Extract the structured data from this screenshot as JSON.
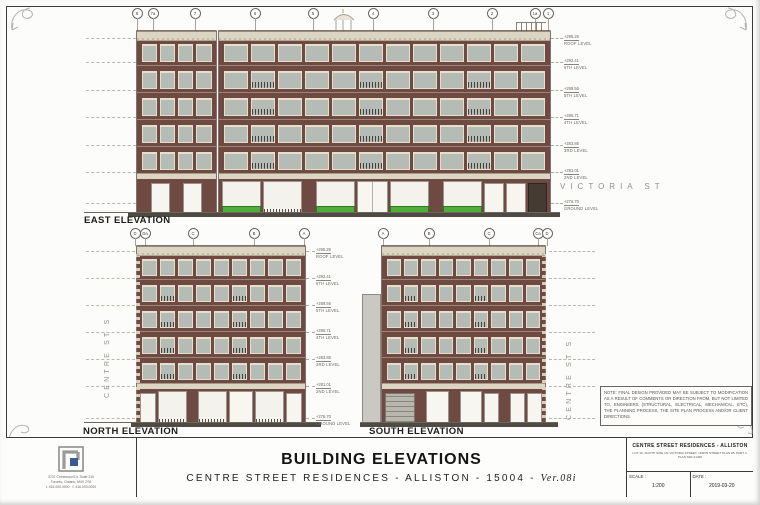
{
  "drawing": {
    "east": {
      "label": "EAST ELEVATION",
      "street": "VICTORIA ST",
      "bubbles": [
        {
          "x": 136,
          "label": "8"
        },
        {
          "x": 152,
          "label": "7a"
        },
        {
          "x": 194,
          "label": "7"
        },
        {
          "x": 254,
          "label": "6"
        },
        {
          "x": 312,
          "label": "5"
        },
        {
          "x": 372,
          "label": "4"
        },
        {
          "x": 432,
          "label": "3"
        },
        {
          "x": 491,
          "label": "2"
        },
        {
          "x": 534,
          "label": "1a"
        },
        {
          "x": 547,
          "label": "1"
        }
      ]
    },
    "north": {
      "label": "NORTH ELEVATION",
      "street": "CENTRE ST S",
      "bubbles": [
        {
          "x": 134,
          "label": "D"
        },
        {
          "x": 144,
          "label": "Da"
        },
        {
          "x": 192,
          "label": "C"
        },
        {
          "x": 253,
          "label": "B"
        },
        {
          "x": 303,
          "label": "A"
        }
      ]
    },
    "south": {
      "label": "SOUTH ELEVATION",
      "street": "CENTRE ST S",
      "bubbles": [
        {
          "x": 382,
          "label": "A"
        },
        {
          "x": 428,
          "label": "B"
        },
        {
          "x": 488,
          "label": "C"
        },
        {
          "x": 537,
          "label": "Ca"
        },
        {
          "x": 546,
          "label": "D"
        }
      ]
    },
    "levels_east": [
      {
        "y": 38,
        "value": "+295.26",
        "name": "ROOF LEVEL"
      },
      {
        "y": 62,
        "value": "+292.41",
        "name": "6TH LEVEL"
      },
      {
        "y": 90,
        "value": "+289.56",
        "name": "5TH LEVEL"
      },
      {
        "y": 117,
        "value": "+286.71",
        "name": "4TH LEVEL"
      },
      {
        "y": 145,
        "value": "+283.86",
        "name": "3RD LEVEL"
      },
      {
        "y": 172,
        "value": "+281.01",
        "name": "2ND LEVEL"
      },
      {
        "y": 203,
        "value": "+276.70",
        "name": "GROUND LEVEL"
      }
    ],
    "levels_lower": [
      {
        "y": 251,
        "value": "+295.26",
        "name": "ROOF LEVEL"
      },
      {
        "y": 278,
        "value": "+292.41",
        "name": "6TH LEVEL"
      },
      {
        "y": 305,
        "value": "+289.56",
        "name": "5TH LEVEL"
      },
      {
        "y": 332,
        "value": "+286.71",
        "name": "4TH LEVEL"
      },
      {
        "y": 359,
        "value": "+283.86",
        "name": "3RD LEVEL"
      },
      {
        "y": 386,
        "value": "+281.01",
        "name": "2ND LEVEL"
      },
      {
        "y": 418,
        "value": "+276.70",
        "name": "GROUND LEVEL"
      }
    ],
    "note": "NOTE: FINAL DESIGN PROVIDED MAY BE SUBJECT TO MODIFICATION AS A RESULT OF COMMENTS OR DIRECTION FROM, BUT NOT LIMITED TO, ENGINEERS (STRUCTURAL, ELECTRICAL, MECHANICAL, ETC), THE PLANNING PROCESS, THE SITE PLAN PROCESS AND/OR CLIENT DIRECTIONS."
  },
  "title_block": {
    "sheet_title": "BUILDING ELEVATIONS",
    "subtitle": "CENTRE STREET RESIDENCES - ALLISTON - 15004 -",
    "version": "Ver.08i",
    "project_name": "CENTRE STREET RESIDENCES - ALLISTON",
    "lot_line": "LOT 10, SOUTH SIDE OF VICTORIA STREET, UNION STREET PLAN 95, PART 4, PLAN 51R-41460",
    "scale_label": "SCALE :",
    "scale_value": "1:200",
    "date_label": "DATE :",
    "date_value": "2019-03-20",
    "address_line1": "3737 Chinewood Dr. Suite 210",
    "address_line2": "Toronto, Ontario, M4V 2Y8",
    "address_line3": "t. 416.000.0000  ·  f. 416.000.0000"
  },
  "colors": {
    "brick": "#6e4a43",
    "cream_trim": "#dcd5c4",
    "glass": "#b5bbb5",
    "storefront_green": "#4fae39",
    "ground_line": "#4f4b42",
    "logo_blue": "#3a5d8f"
  },
  "facades": {
    "east_left": {
      "floors": 5,
      "cols": 4,
      "railings": false,
      "ground": [
        "pier",
        "open",
        "pier",
        "open",
        "pier"
      ]
    },
    "east_main": {
      "floors": 5,
      "cols": 12,
      "railings": true,
      "ground": [
        "glass-green",
        "glass",
        "pier",
        "glass-green",
        "door",
        "glass-green",
        "pier",
        "glass-green",
        "open",
        "open",
        "dark"
      ]
    },
    "north_main": {
      "floors": 5,
      "cols": 9,
      "railings": true,
      "ground": [
        "open",
        "glass",
        "pier",
        "glass",
        "door",
        "glass",
        "open"
      ]
    },
    "south_main": {
      "floors": 5,
      "cols": 9,
      "railings": true,
      "ground": [
        "garage",
        "pier",
        "door",
        "pier",
        "door",
        "open",
        "pier",
        "open",
        "open"
      ]
    }
  }
}
